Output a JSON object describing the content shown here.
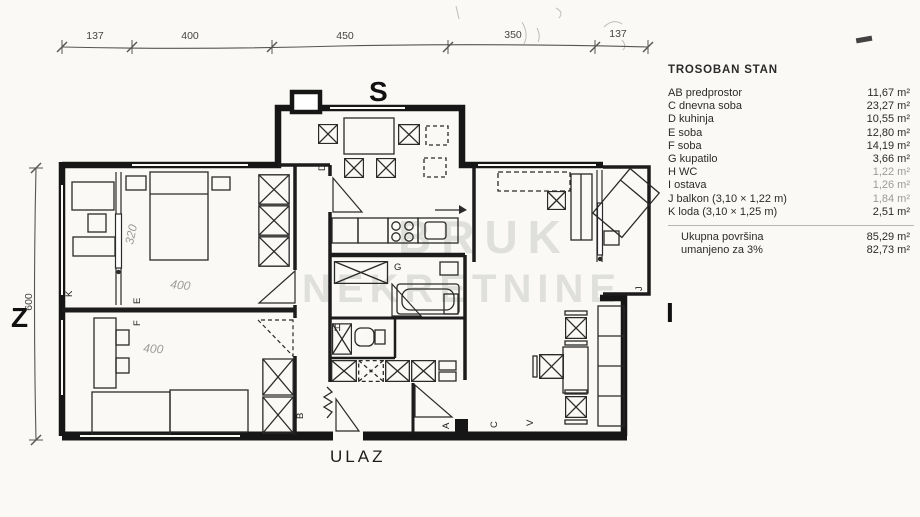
{
  "compass": {
    "north": "S",
    "west": "Z",
    "east": "I"
  },
  "entrance_label": "ULAZ",
  "dimensions": {
    "top": [
      "137",
      "400",
      "450",
      "350",
      "137"
    ],
    "left": "600"
  },
  "rooms": {
    "a": "A",
    "b": "B",
    "c": "C",
    "d": "D",
    "e": "E",
    "f": "F",
    "g": "G",
    "h": "H",
    "j": "J",
    "k": "K",
    "v": "V"
  },
  "annotations": {
    "hand1": "320",
    "hand2": "400",
    "hand3": "400"
  },
  "watermark": {
    "line1": "BRUK",
    "line2": "NEKRETNINE"
  },
  "legend": {
    "title": "TROSOBAN STAN",
    "items": [
      {
        "label": "AB predprostor",
        "value": "11,67 m²"
      },
      {
        "label": "C dnevna soba",
        "value": "23,27 m²"
      },
      {
        "label": "D kuhinja",
        "value": "10,55 m²"
      },
      {
        "label": "E soba",
        "value": "12,80 m²"
      },
      {
        "label": "F soba",
        "value": "14,19 m²"
      },
      {
        "label": "G kupatilo",
        "value": "3,66 m²"
      },
      {
        "label": "H WC",
        "value": "1,22 m²"
      },
      {
        "label": "I ostava",
        "value": "1,26 m²"
      },
      {
        "label": "J balkon (3,10 × 1,22 m)",
        "value": "1,84 m²"
      },
      {
        "label": "K loda (3,10 × 1,25 m)",
        "value": "2,51 m²"
      }
    ],
    "total_label": "Ukupna površina",
    "total_value": "85,29 m²",
    "reduced_label": "umanjeno za 3%",
    "reduced_value": "82,73 m²"
  }
}
